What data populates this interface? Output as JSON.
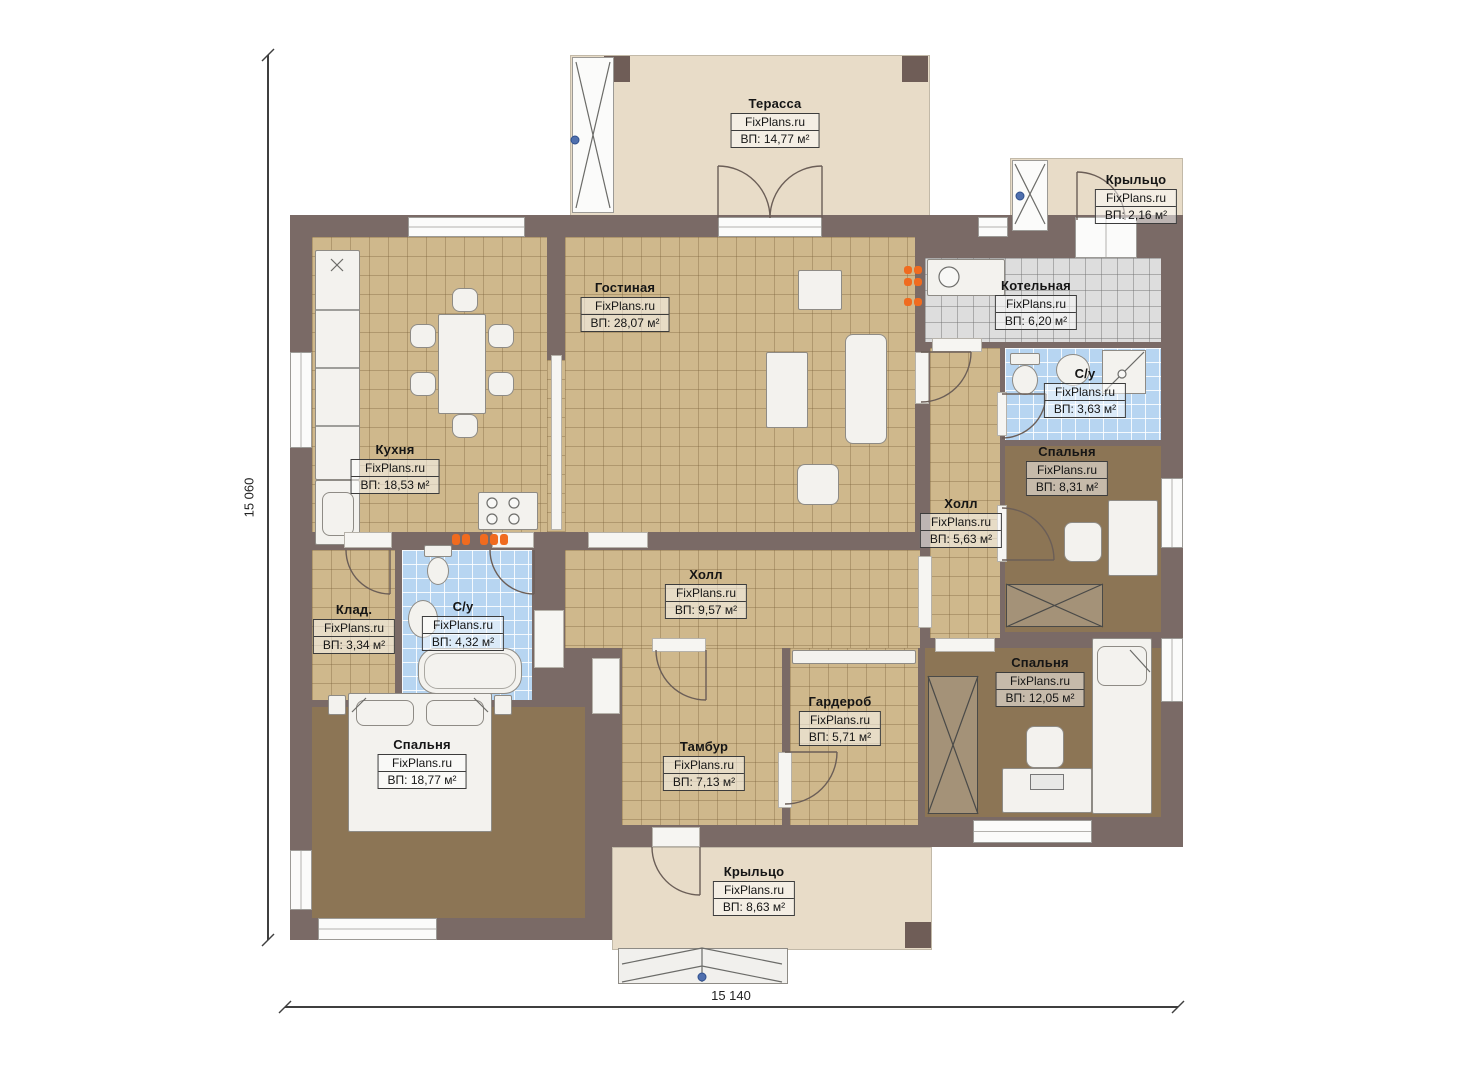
{
  "brand": "FixPlans.ru",
  "dimensions": {
    "vertical": "15 060",
    "horizontal": "15 140"
  },
  "rooms": [
    {
      "id": "terrace",
      "name": "Терасса",
      "brand": "FixPlans.ru",
      "area": "ВП: 14,77 м²"
    },
    {
      "id": "porch-top",
      "name": "Крыльцо",
      "brand": "FixPlans.ru",
      "area": "ВП: 2,16 м²"
    },
    {
      "id": "living-room",
      "name": "Гостиная",
      "brand": "FixPlans.ru",
      "area": "ВП: 28,07 м²"
    },
    {
      "id": "boiler-room",
      "name": "Котельная",
      "brand": "FixPlans.ru",
      "area": "ВП: 6,20 м²"
    },
    {
      "id": "bathroom-right",
      "name": "С/у",
      "brand": "FixPlans.ru",
      "area": "ВП: 3,63 м²"
    },
    {
      "id": "bedroom-right",
      "name": "Спальня",
      "brand": "FixPlans.ru",
      "area": "ВП: 8,31 м²"
    },
    {
      "id": "kitchen",
      "name": "Кухня",
      "brand": "FixPlans.ru",
      "area": "ВП: 18,53 м²"
    },
    {
      "id": "hall-right",
      "name": "Холл",
      "brand": "FixPlans.ru",
      "area": "ВП: 5,63 м²"
    },
    {
      "id": "hall-center",
      "name": "Холл",
      "brand": "FixPlans.ru",
      "area": "ВП: 9,57 м²"
    },
    {
      "id": "storage",
      "name": "Клад.",
      "brand": "FixPlans.ru",
      "area": "ВП: 3,34 м²"
    },
    {
      "id": "bathroom-center",
      "name": "С/у",
      "brand": "FixPlans.ru",
      "area": "ВП: 4,32 м²"
    },
    {
      "id": "bedroom-left",
      "name": "Спальня",
      "brand": "FixPlans.ru",
      "area": "ВП: 18,77 м²"
    },
    {
      "id": "vestibule",
      "name": "Тамбур",
      "brand": "FixPlans.ru",
      "area": "ВП: 7,13 м²"
    },
    {
      "id": "wardrobe-room",
      "name": "Гардероб",
      "brand": "FixPlans.ru",
      "area": "ВП: 5,71 м²"
    },
    {
      "id": "bedroom-bottom-right",
      "name": "Спальня",
      "brand": "FixPlans.ru",
      "area": "ВП: 12,05 м²"
    },
    {
      "id": "porch-bottom",
      "name": "Крыльцо",
      "brand": "FixPlans.ru",
      "area": "ВП: 8,63 м²"
    }
  ],
  "colors": {
    "wall": "#7a6a66",
    "floor_tan": "#cfb88c",
    "floor_blue": "#b7d5f1",
    "floor_gray": "#dddddd",
    "carpet": "#8c7555",
    "porch": "#e8dcc8",
    "radiator_orange": "#f06b1f"
  }
}
